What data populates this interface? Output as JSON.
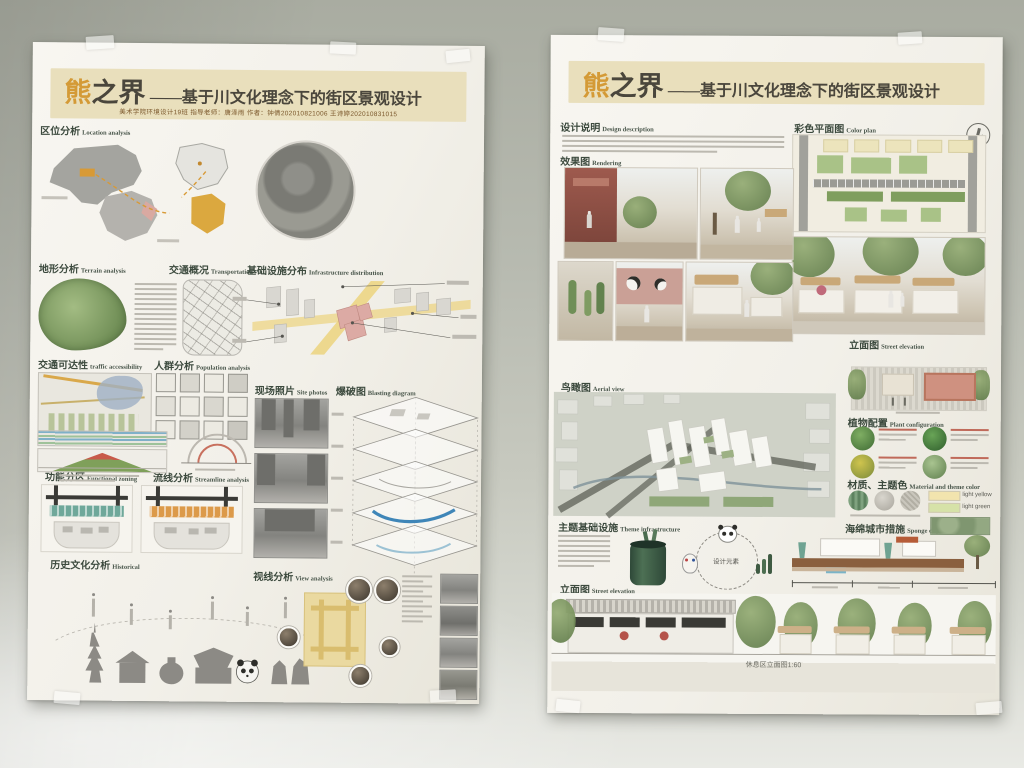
{
  "title": {
    "accent_char": "熊",
    "rest_chars": "之界",
    "dash": "——",
    "subtitle": "基于川文化理念下的街区景观设计",
    "accent_color": "#d49a36",
    "band_color": "#e9dfbc",
    "text_color": "#4a463c"
  },
  "left_poster": {
    "credits": "美术学院环境设计19班  指导老师：唐泽雨   作者：钟倩202010821006  王诗婷202010831015",
    "sections": {
      "location": {
        "zh": "区位分析",
        "en": "Location analysis"
      },
      "terrain": {
        "zh": "地形分析",
        "en": "Terrain analysis"
      },
      "transport": {
        "zh": "交通概况",
        "en": "Transportation"
      },
      "infrastructure": {
        "zh": "基础设施分布",
        "en": "Infrastructure distribution"
      },
      "accessibility": {
        "zh": "交通可达性",
        "en": "traffic accessibility"
      },
      "population": {
        "zh": "人群分析",
        "en": "Population analysis"
      },
      "site_photos": {
        "zh": "现场照片",
        "en": "Site photos"
      },
      "blasting": {
        "zh": "爆破图",
        "en": "Blasting diagram"
      },
      "climate": {
        "zh": "气候分析",
        "en": "Climate analysis"
      },
      "zoning": {
        "zh": "功能分区",
        "en": "Functional zoning"
      },
      "streamline": {
        "zh": "流线分析",
        "en": "Streamline analysis"
      },
      "historical": {
        "zh": "历史文化分析",
        "en": "Historical"
      },
      "view": {
        "zh": "视线分析",
        "en": "View analysis"
      }
    }
  },
  "right_poster": {
    "sections": {
      "description": {
        "zh": "设计说明",
        "en": "Design description"
      },
      "color_plan": {
        "zh": "彩色平面图",
        "en": "Color plan"
      },
      "rendering": {
        "zh": "效果图",
        "en": "Rendering"
      },
      "aerial": {
        "zh": "鸟瞰图",
        "en": "Aerial view"
      },
      "elevation_right": {
        "zh": "立面图",
        "en": "Street elevation"
      },
      "plants": {
        "zh": "植物配置",
        "en": "Plant configuration"
      },
      "materials": {
        "zh": "材质、主题色",
        "en": "Material and theme color"
      },
      "theme_infra": {
        "zh": "主题基础设施",
        "en": "Theme infrastructure"
      },
      "sponge": {
        "zh": "海绵城市措施",
        "en": "Sponge city measures"
      },
      "elevation_bottom": {
        "zh": "立面图",
        "en": "Street elevation"
      }
    },
    "swatches": [
      {
        "label": "light yellow",
        "color": "#f2e4ae"
      },
      {
        "label": "light green",
        "color": "#d6e2a8"
      }
    ],
    "infra_center_label": "设计元素",
    "bottom_caption": "休息区立面图1:60"
  }
}
